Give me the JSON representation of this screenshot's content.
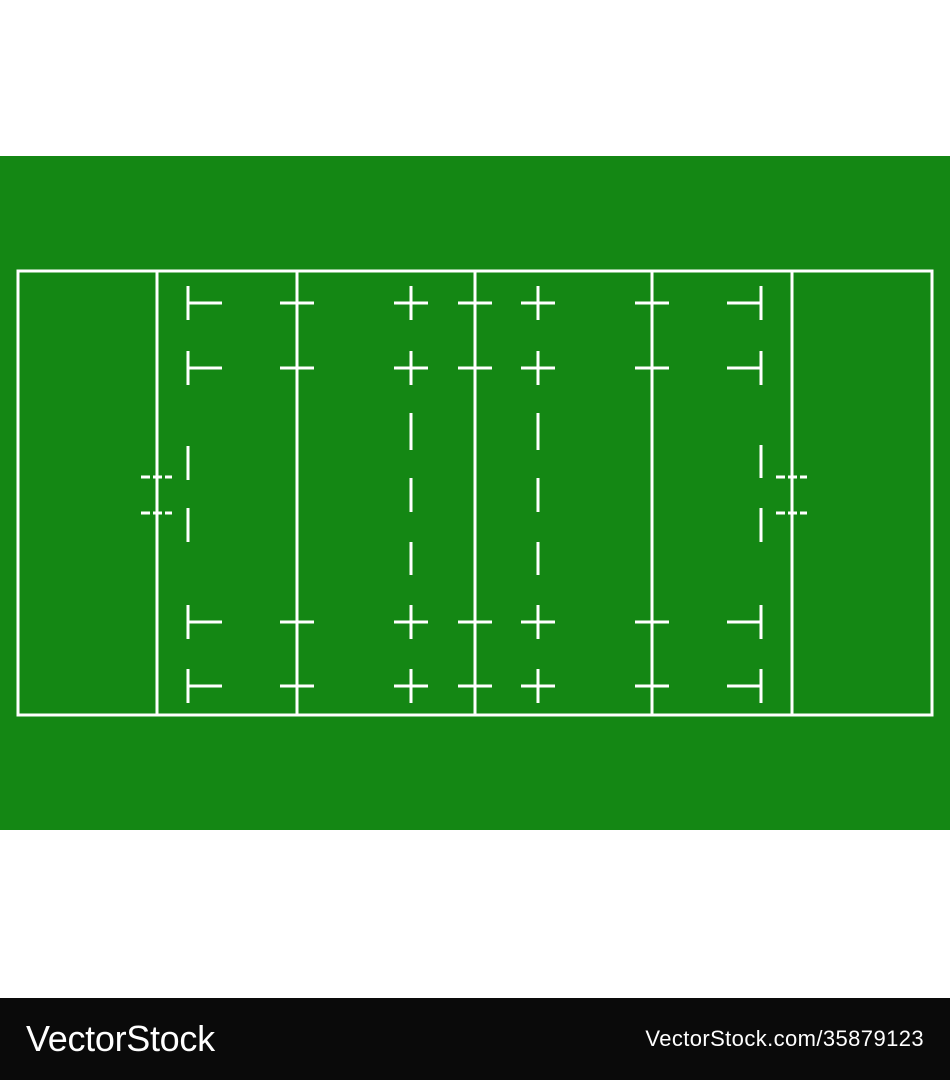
{
  "colors": {
    "background": "#ffffff",
    "pitch_green": "#148714",
    "line_white": "#ffffff",
    "watermark_bar": "#0a0a0a",
    "watermark_text": "#ffffff"
  },
  "watermark": {
    "logo_text": "VectorStock",
    "image_url_text": "VectorStock.com/35879123"
  },
  "field": {
    "green_band": {
      "y": 156,
      "height": 674
    },
    "line_width": 3,
    "border": {
      "x": 18,
      "y": 271,
      "width": 914,
      "height": 444
    },
    "solid_vertical_lines": [
      {
        "name": "goal-line-left",
        "x": 157
      },
      {
        "name": "twenty-two-metre-line-left",
        "x": 297
      },
      {
        "name": "halfway-line",
        "x": 475
      },
      {
        "name": "twenty-two-metre-line-right",
        "x": 652
      },
      {
        "name": "goal-line-right",
        "x": 792
      }
    ],
    "mark_rows_y": [
      303,
      368,
      622,
      686
    ],
    "arm_half_length": 17,
    "stroke_half_length": 17,
    "cross_marked_lines_x": [
      297,
      475,
      652
    ],
    "ten_metre_dash_lines": [
      {
        "name": "ten-metre-dash-line-left",
        "x": 411,
        "middle_dashes": [
          [
            413,
            450
          ],
          [
            478,
            512
          ],
          [
            542,
            575
          ]
        ]
      },
      {
        "name": "ten-metre-dash-line-right",
        "x": 538,
        "middle_dashes": [
          [
            413,
            450
          ],
          [
            478,
            512
          ],
          [
            542,
            575
          ]
        ]
      }
    ],
    "five_metre_dash_lines": [
      {
        "name": "five-metre-dash-line-left",
        "x": 188,
        "arm_direction": 1,
        "middle_dashes": [
          [
            446,
            480
          ],
          [
            508,
            542
          ]
        ]
      },
      {
        "name": "five-metre-dash-line-right",
        "x": 761,
        "arm_direction": -1,
        "middle_dashes": [
          [
            445,
            478
          ],
          [
            508,
            542
          ]
        ]
      }
    ],
    "goal_line_ticks": {
      "lines_x": [
        157,
        792
      ],
      "rows_y": [
        477,
        513
      ],
      "half_width": 16,
      "dash_pattern": "9 3"
    }
  },
  "watermark_bar_geometry": {
    "y": 998,
    "height": 82
  }
}
